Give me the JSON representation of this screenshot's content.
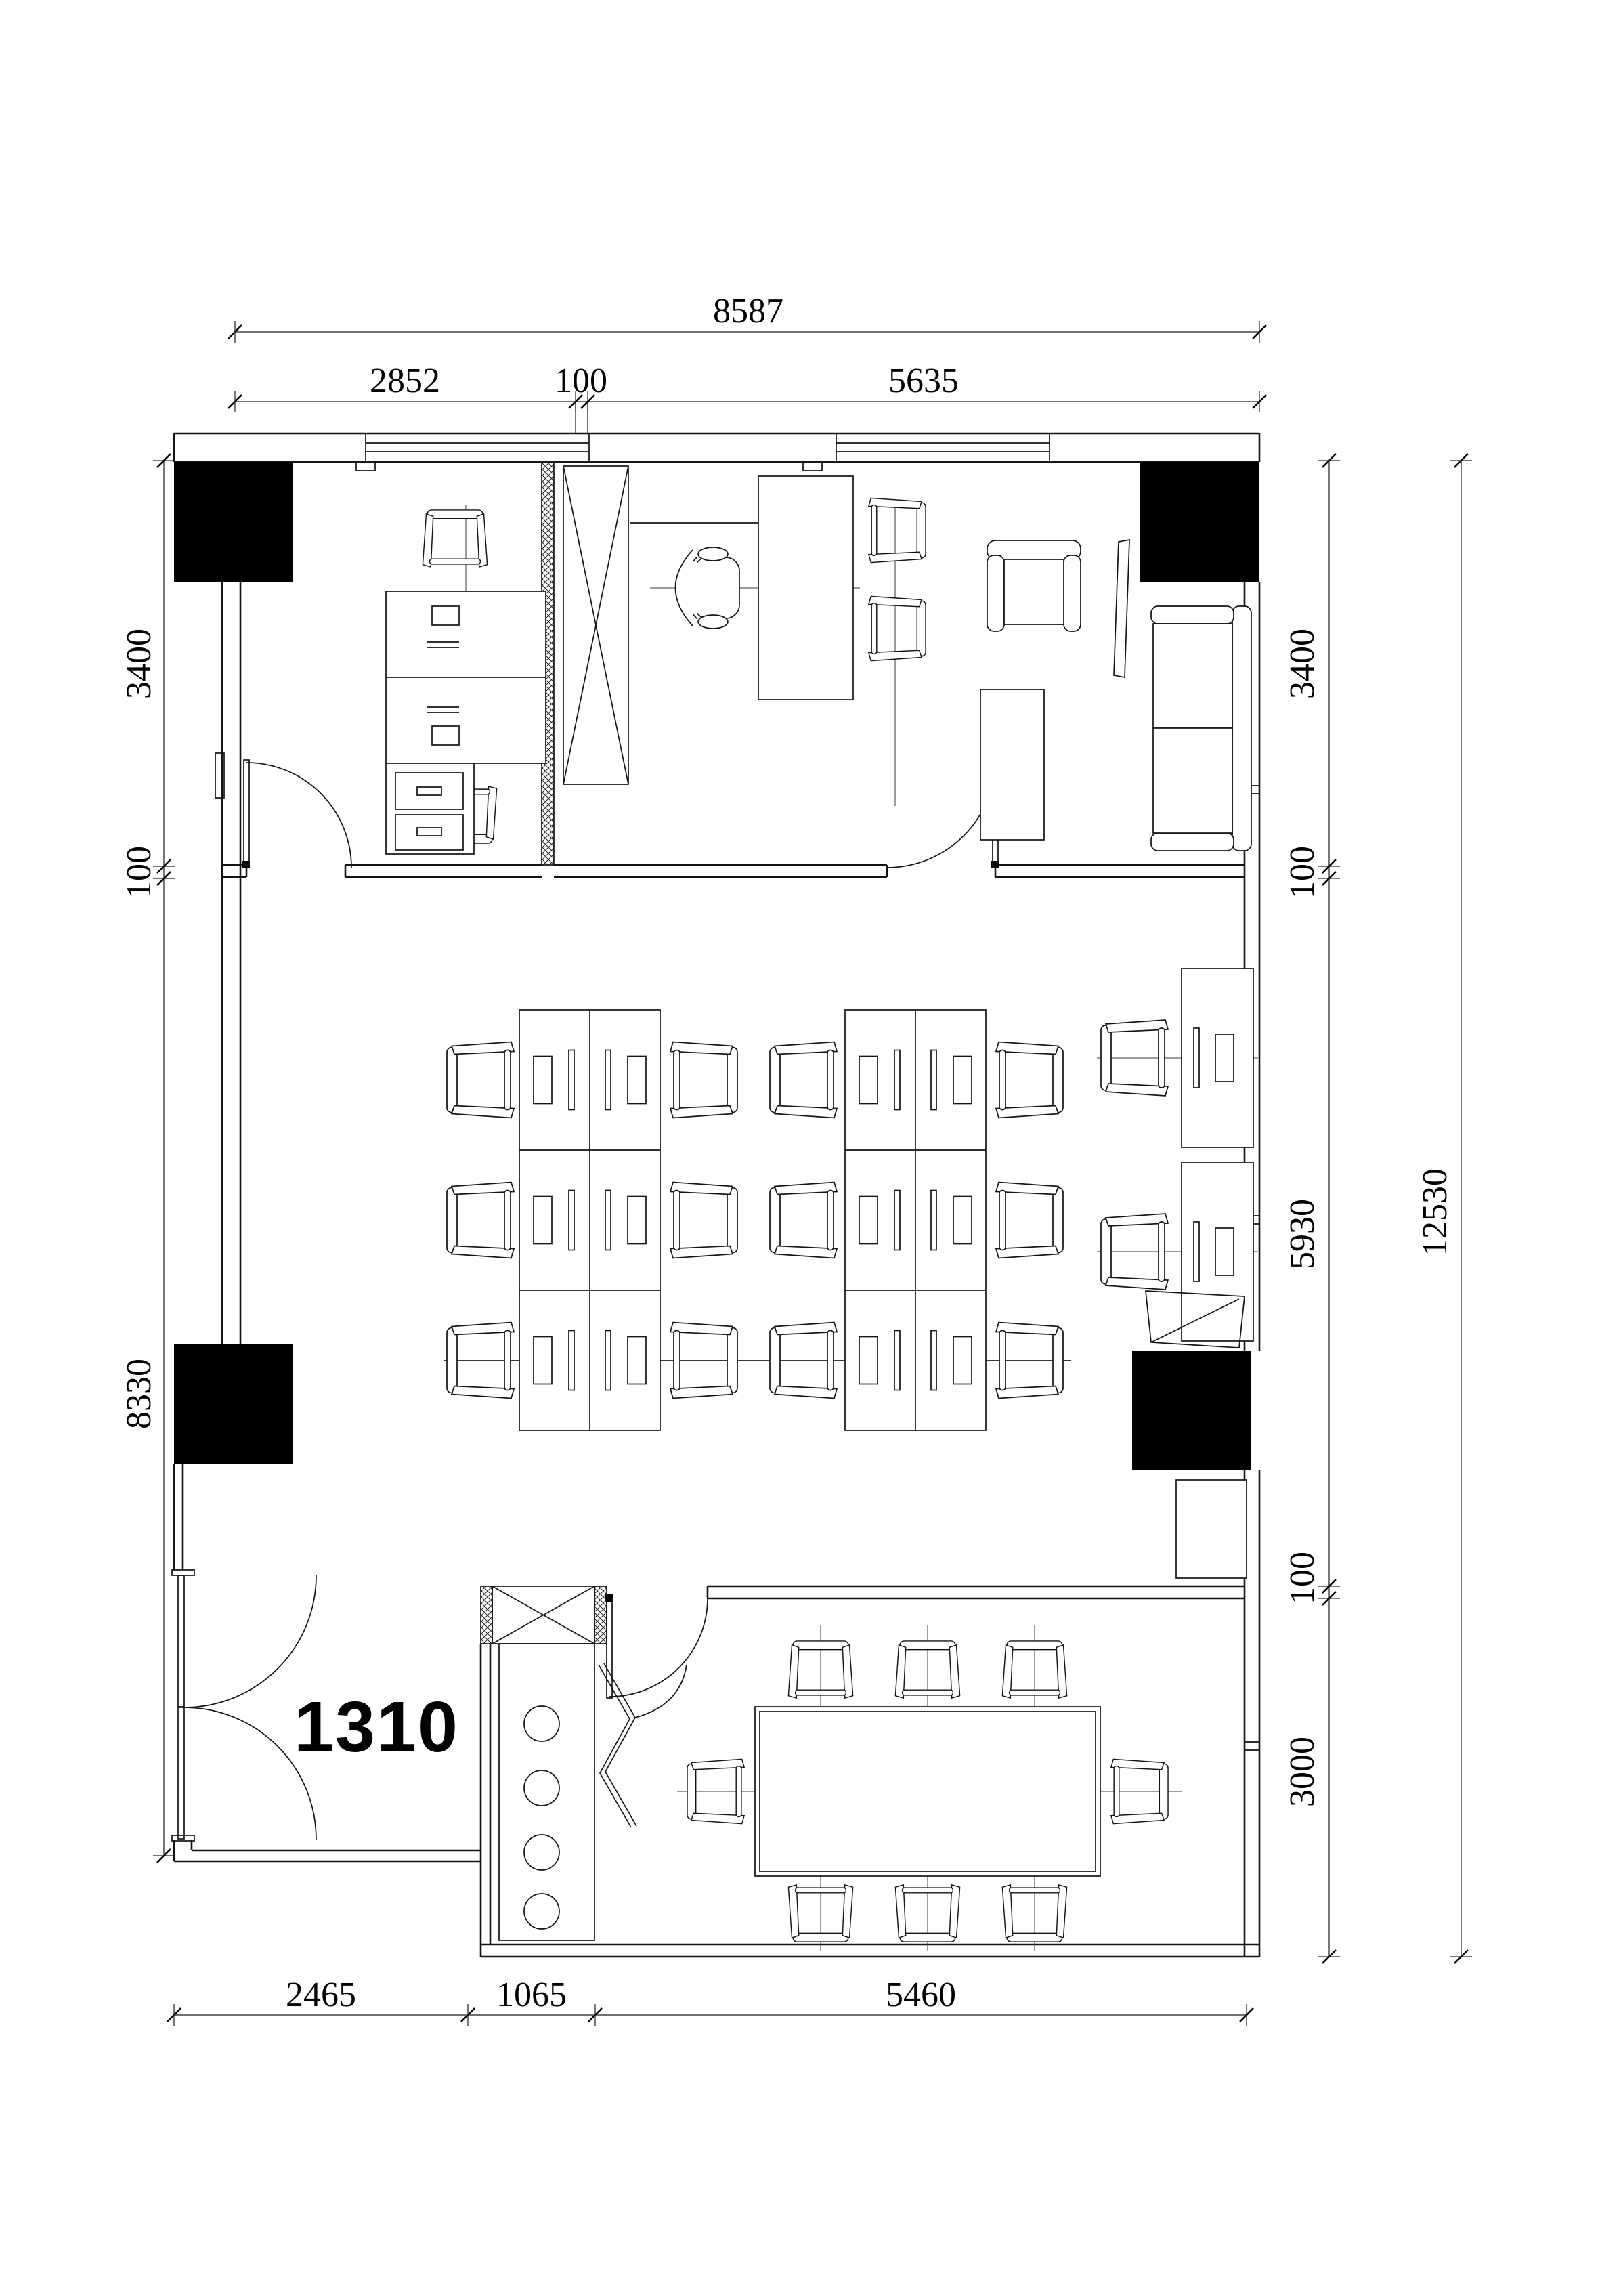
{
  "drawing": {
    "title": "office-unit-floor-plan",
    "room_label": "1310",
    "dimensions": {
      "top_outer": {
        "total": "8587"
      },
      "top_inner": {
        "left_office": "2852",
        "partition": "100",
        "right_office": "5635"
      },
      "left_chain": {
        "office_depth": "3400",
        "wall": "100",
        "lower_zone": "8330"
      },
      "right_inner": {
        "office_depth": "3400",
        "wall_upper": "100",
        "open_office": "5930",
        "wall_lower": "100",
        "meeting_room": "3000"
      },
      "right_outer": {
        "total": "12530"
      },
      "bottom": {
        "left": "2465",
        "middle": "1065",
        "right": "5460"
      }
    },
    "colors": {
      "line": "#141414",
      "background": "#ffffff",
      "column_fill": "#000000"
    },
    "legend": {
      "solid_black_squares": "structural columns",
      "x_boxes": "cabinet / shaft",
      "hatched_strips": "partition walls"
    }
  }
}
